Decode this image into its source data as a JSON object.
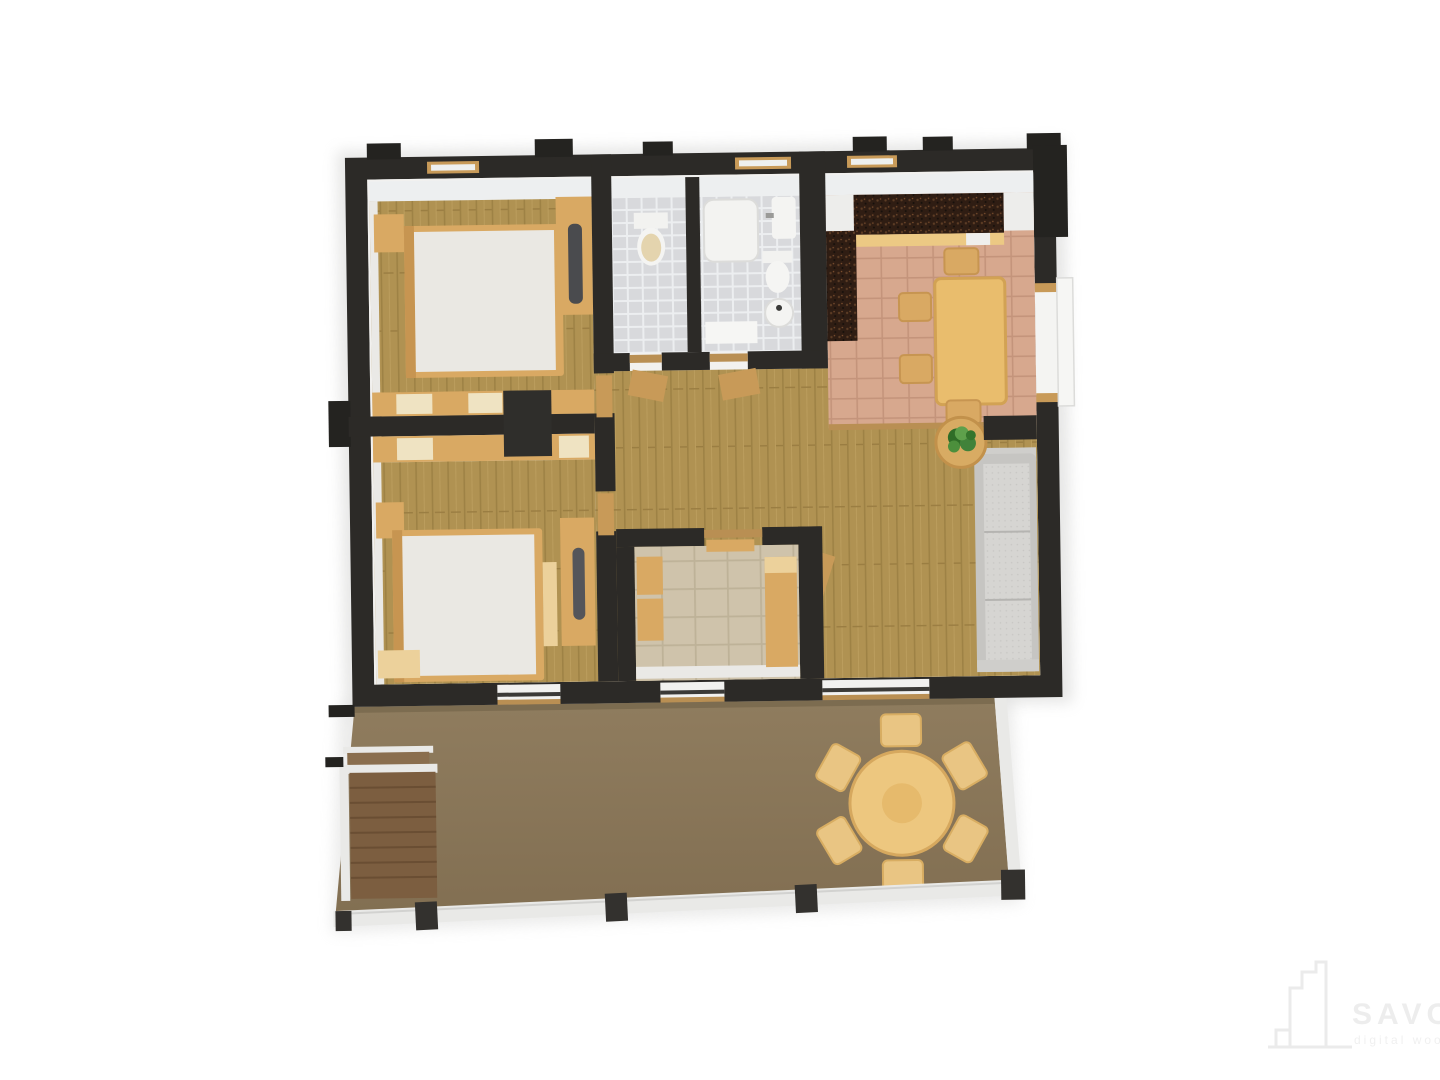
{
  "page": {
    "background": "#ffffff",
    "type": "3d-top-down-floor-plan-render"
  },
  "watermark": {
    "icon": "building-logo-icon",
    "brand": "SAVODZ",
    "tagline": "digital wood"
  },
  "palette": {
    "wall": "#2c2a27",
    "wallStub": "#242320",
    "face": "#edeff0",
    "faceSide": "#eae9e6",
    "innerWhite": "#f2f1ef",
    "wood": "#b09252",
    "woodLine": "#9e8245",
    "kitchenTile": "#d7a88e",
    "kitchenTileLine": "#c4947b",
    "bathTile": "#d8d9dc",
    "bathGrout": "#eceef0",
    "roomTile": "#cfc3ab",
    "roomTileLine": "#beb298",
    "counter": "#2f1d13",
    "counterFleck": "#5c3c25",
    "tan": "#d9a963",
    "tanLight": "#ecd19b",
    "cream": "#efe3c2",
    "tableWood": "#e9bd6d",
    "tableEdge": "#d2a254",
    "mattress": "#eae8e3",
    "headboard": "#c79551",
    "sofaBase": "#c6c5c2",
    "sofaCushion": "#d6d5d2",
    "sofaSeam": "#b5b4b1",
    "plant": "#41823a",
    "plantDark": "#2f6d27",
    "plantLight": "#5ea04b",
    "terraceA": "#8f7c5e",
    "terraceB": "#826f52",
    "stairs": "#7c5e40",
    "stairsLine": "#6a4e33",
    "rail": "#e9e9e7",
    "post": "#33312e",
    "threshold": "#b98f53",
    "doorTan": "#c89a58",
    "whiteGoods": "#ededeb",
    "grayAccent": "#54555a",
    "watermark": "#ededed"
  },
  "rooms": [
    {
      "id": "bedroom-1",
      "position": "top-left",
      "floor": "wood",
      "furniture": [
        "double-bed",
        "nightstand",
        "wardrobe",
        "built-in-closet-row"
      ]
    },
    {
      "id": "wc",
      "position": "top-center-left",
      "floor": "gray-tile",
      "furniture": [
        "toilet"
      ]
    },
    {
      "id": "bathroom",
      "position": "top-center",
      "floor": "gray-tile",
      "furniture": [
        "shower-tub",
        "sink",
        "toilet",
        "round-basin",
        "bath-mat"
      ]
    },
    {
      "id": "kitchen-dining",
      "position": "top-right",
      "floor": "terracotta-tile",
      "furniture": [
        "dark-counter-l-shape",
        "fridge",
        "cabinets",
        "dining-table",
        "four-chairs"
      ]
    },
    {
      "id": "hallway",
      "position": "center",
      "floor": "wood",
      "furniture": [
        "open-doors",
        "small-cabinets"
      ]
    },
    {
      "id": "living-area",
      "position": "right",
      "floor": "wood",
      "furniture": [
        "sofa",
        "round-side-table",
        "potted-plant",
        "open-door"
      ]
    },
    {
      "id": "small-room",
      "position": "bottom-center",
      "floor": "beige-tile",
      "furniture": [
        "cabinets",
        "bench-bed",
        "shelf"
      ]
    },
    {
      "id": "bedroom-2",
      "position": "bottom-left",
      "floor": "wood",
      "furniture": [
        "double-bed",
        "nightstand",
        "desk-with-tv",
        "wardrobe-row",
        "low-cabinet"
      ]
    },
    {
      "id": "terrace",
      "position": "bottom",
      "floor": "brown-deck",
      "furniture": [
        "round-table-six-chairs",
        "wood-stairs",
        "white-railing",
        "railing-posts"
      ]
    }
  ]
}
